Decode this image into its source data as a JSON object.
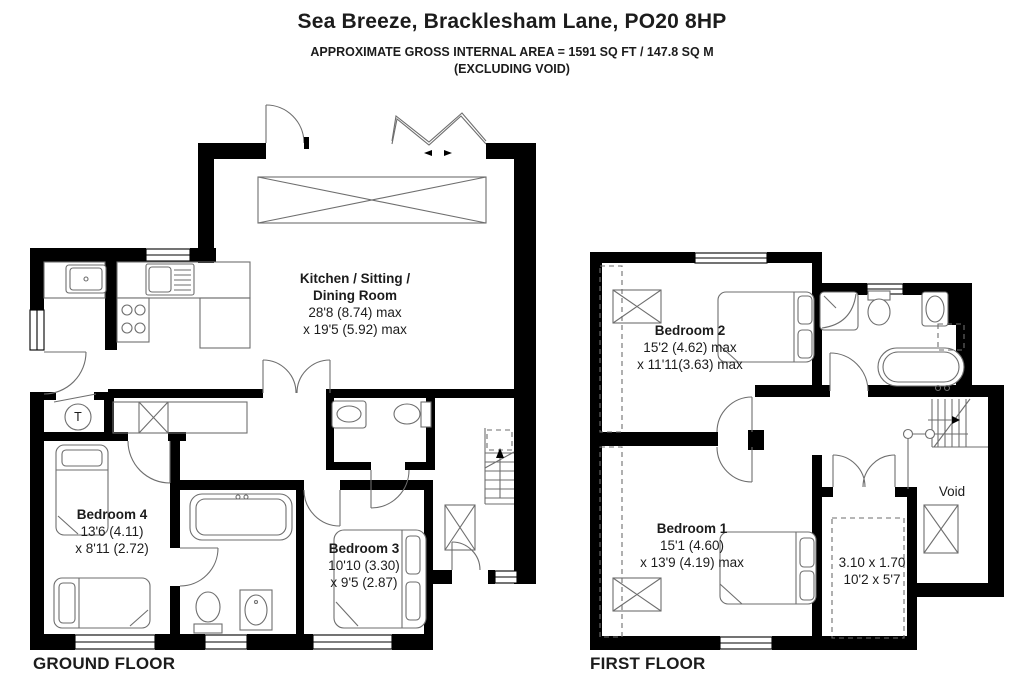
{
  "header": {
    "title": "Sea Breeze, Bracklesham Lane, PO20 8HP",
    "subtitle_line1": "APPROXIMATE GROSS INTERNAL AREA = 1591 SQ FT / 147.8 SQ M",
    "subtitle_line2": "(EXCLUDING VOID)"
  },
  "floors": {
    "ground_label": "GROUND FLOOR",
    "first_label": "FIRST FLOOR"
  },
  "rooms": {
    "kitchen": {
      "name_line1": "Kitchen / Sitting /",
      "name_line2": "Dining Room",
      "dims_line1": "28'8 (8.74) max",
      "dims_line2": "x 19'5 (5.92) max"
    },
    "bedroom4": {
      "name": "Bedroom 4",
      "dims_line1": "13'6 (4.11)",
      "dims_line2": "x 8'11 (2.72)"
    },
    "bedroom3": {
      "name": "Bedroom 3",
      "dims_line1": "10'10 (3.30)",
      "dims_line2": "x 9'5 (2.87)"
    },
    "bedroom2": {
      "name": "Bedroom 2",
      "dims_line1": "15'2 (4.62) max",
      "dims_line2": "x 11'11(3.63) max"
    },
    "bedroom1": {
      "name": "Bedroom 1",
      "dims_line1": "15'1 (4.60)",
      "dims_line2": "x 13'9 (4.19) max"
    },
    "landing_store": {
      "dims_line1": "3.10 x 1.70",
      "dims_line2": "10'2 x 5'7"
    },
    "void": {
      "name": "Void"
    },
    "tank_cupboard": {
      "label": "T"
    }
  },
  "colors": {
    "wall": "#000000",
    "fixture_line": "#6e6e6e",
    "text": "#1c1c1c",
    "background": "#ffffff"
  }
}
